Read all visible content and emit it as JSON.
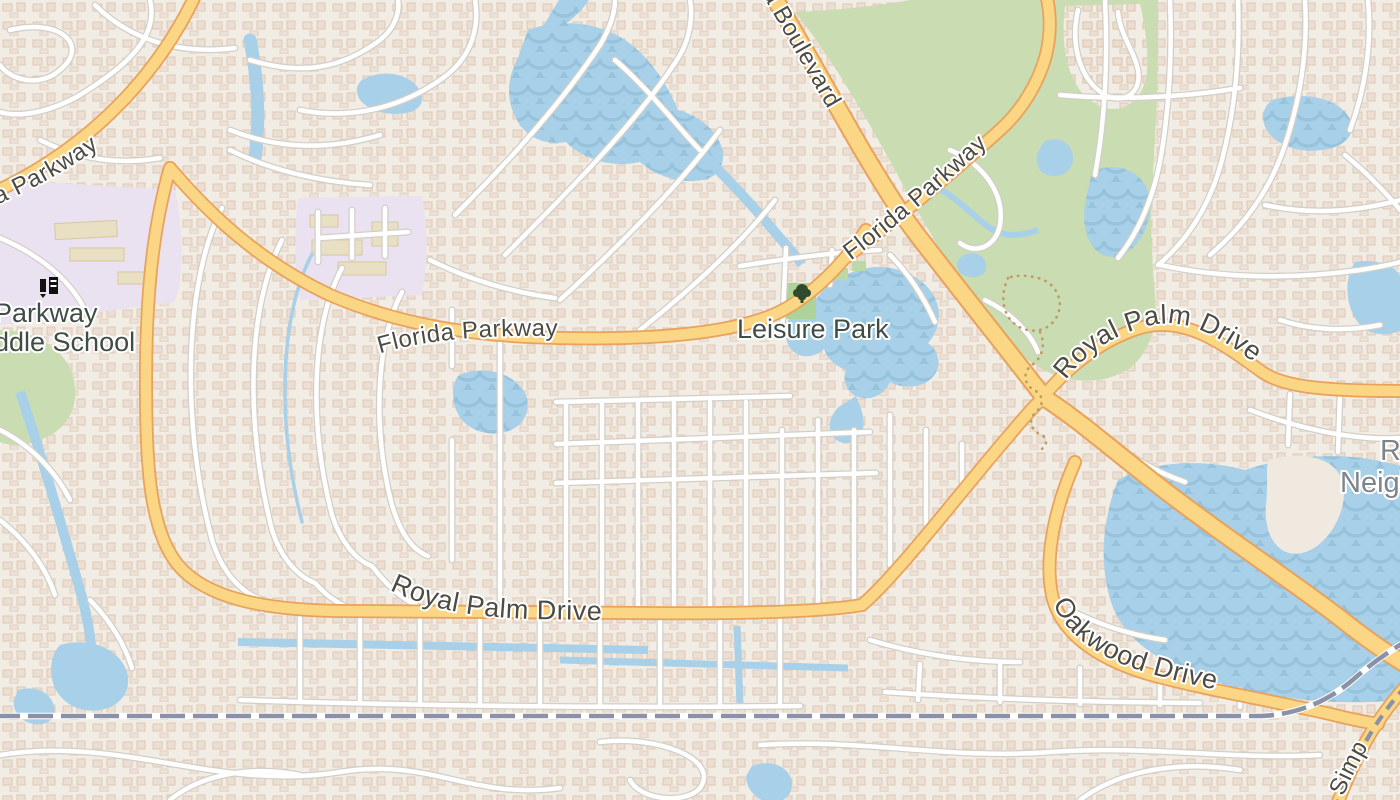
{
  "map": {
    "type": "street-map",
    "labels": {
      "road_top_left": "a Parkway",
      "school_line1": "Parkway",
      "school_line2": "ddle School",
      "florida_parkway_west": "Florida Parkway",
      "florida_parkway_ne": "Florida Parkway",
      "boulevard_partial": "a Boulevard",
      "leisure_park": "Leisure Park",
      "royal_palm_drive_ne": "Royal Palm Drive",
      "royal_palm_drive_south": "Royal Palm Drive",
      "oakwood_drive": "Oakwood Drive",
      "neighborhood_line1": "R",
      "neighborhood_line2": "Neigh",
      "rail_road_partial": "Simp"
    },
    "icons": {
      "tree": "tree-icon",
      "school": "school-icon"
    },
    "colors": {
      "land": "#f2eee7",
      "residential_house": "#eadccf",
      "water": "#a8d0e8",
      "water_wave": "#96c2db",
      "green_area": "#c9dcb2",
      "park_green": "#aed398",
      "school_area": "#eae1f1",
      "road_major_fill": "#fbd684",
      "road_major_casing": "#e8a25c",
      "road_minor_fill": "#ffffff",
      "road_minor_casing": "#d2cfc8",
      "railway": "#8b91a6",
      "label_road": "#4d4b45",
      "label_place": "#3f4d45",
      "label_neighborhood": "#7e848a",
      "trail": "#bd9c66"
    }
  }
}
